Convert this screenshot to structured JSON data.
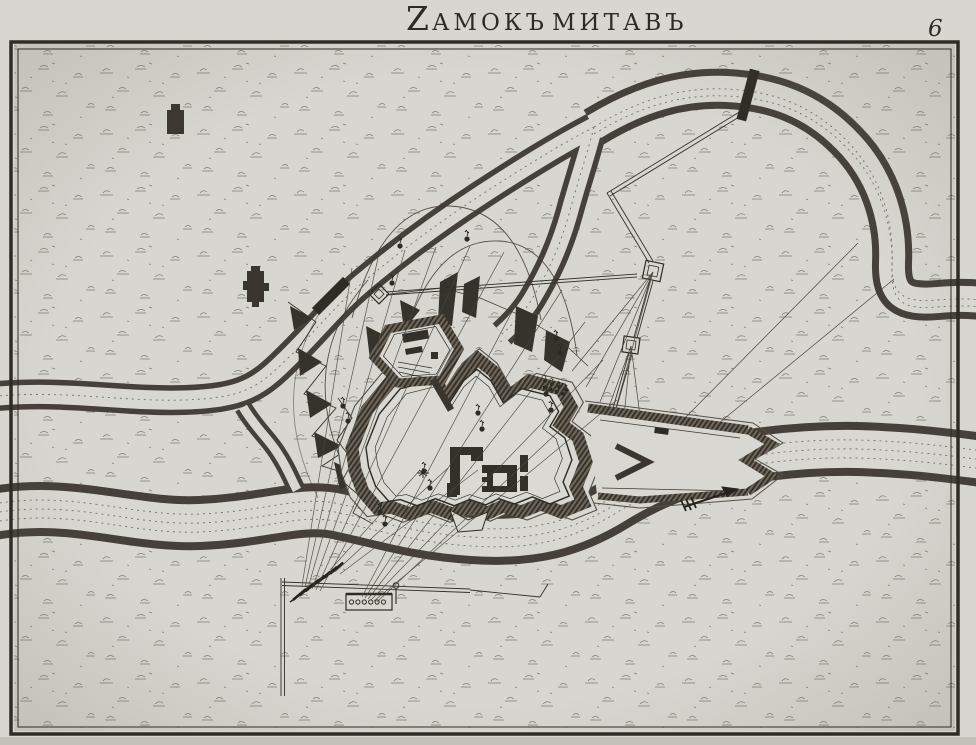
{
  "plate": {
    "title": {
      "full": "Zамокъ митавъ",
      "initial": "Z",
      "word1_rest": "АМОКЪ",
      "word2": "МИТАВЪ"
    },
    "page_number": "6"
  },
  "colors": {
    "paper": "#d8d6d0",
    "paper_light": "#dcdad4",
    "ink": "#2e2b25",
    "bank": "#45403a",
    "water_line": "#5d574d",
    "moat": "#3a362f"
  },
  "features": [
    "main-river",
    "north-river-branch",
    "river-loop",
    "river-neck",
    "confluence-channel",
    "star-fortress",
    "fortress-buildings",
    "east-hornwork",
    "northwest-outwork",
    "siege-zigzag-trenches",
    "siege-parallel-trench",
    "siege-redoubts",
    "south-battery-trench",
    "gun-battery",
    "mortar-battery",
    "fire-lines",
    "bomb-trajectories",
    "bomb-symbols",
    "bridge",
    "flow-arrow",
    "church-building",
    "farm-building"
  ]
}
